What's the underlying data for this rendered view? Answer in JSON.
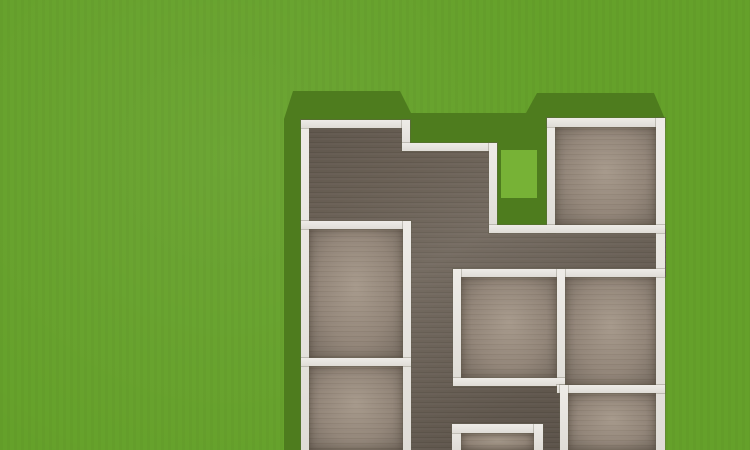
{
  "scene": {
    "width": 750,
    "height": 450,
    "view": "top-down floor plan of a house on a grass lot"
  },
  "colors": {
    "grass": "#65a12a",
    "shadow": "#4e7c1e",
    "courtyard_sunlit": "#77b236",
    "wall": "#e8e5df",
    "dark_floor": "#675d52",
    "light_floor": "#93867a"
  },
  "geometry": {
    "shadow_polygon": [
      [
        284,
        450
      ],
      [
        284,
        119
      ],
      [
        293,
        91
      ],
      [
        400,
        91
      ],
      [
        411,
        113
      ],
      [
        526,
        113
      ],
      [
        537,
        93
      ],
      [
        654,
        93
      ],
      [
        665,
        119
      ],
      [
        665,
        150
      ],
      [
        310,
        150
      ],
      [
        310,
        450
      ]
    ],
    "courtyard": {
      "shadow": {
        "x": 493,
        "y": 135,
        "w": 62,
        "h": 98
      },
      "sunlit": {
        "x": 501,
        "y": 150,
        "w": 36,
        "h": 48
      }
    },
    "hallway_polygon": [
      [
        305,
        124
      ],
      [
        407,
        124
      ],
      [
        407,
        147
      ],
      [
        497,
        147
      ],
      [
        497,
        229
      ],
      [
        666,
        229
      ],
      [
        666,
        277
      ],
      [
        457,
        277
      ],
      [
        457,
        382
      ],
      [
        564,
        382
      ],
      [
        564,
        450
      ],
      [
        407,
        450
      ],
      [
        407,
        229
      ],
      [
        305,
        229
      ]
    ],
    "rooms": [
      {
        "id": "room-top-right",
        "x": 555,
        "y": 127,
        "w": 101,
        "h": 98
      },
      {
        "id": "room-left-middle",
        "x": 309,
        "y": 229,
        "w": 94,
        "h": 129
      },
      {
        "id": "room-left-bottom",
        "x": 309,
        "y": 366,
        "w": 94,
        "h": 84
      },
      {
        "id": "room-center",
        "x": 461,
        "y": 277,
        "w": 96,
        "h": 101
      },
      {
        "id": "room-right-middle",
        "x": 565,
        "y": 277,
        "w": 91,
        "h": 108
      },
      {
        "id": "room-bottom-center",
        "x": 461,
        "y": 433,
        "w": 73,
        "h": 17
      },
      {
        "id": "room-bottom-right",
        "x": 568,
        "y": 393,
        "w": 88,
        "h": 57
      }
    ],
    "walls": [
      {
        "id": "wall-exterior-west",
        "x": 301,
        "y": 120,
        "w": 8,
        "h": 330
      },
      {
        "id": "wall-top-left",
        "x": 301,
        "y": 120,
        "w": 109,
        "h": 8
      },
      {
        "id": "wall-step",
        "x": 402,
        "y": 120,
        "w": 8,
        "h": 31
      },
      {
        "id": "wall-top-recess",
        "x": 402,
        "y": 143,
        "w": 95,
        "h": 8
      },
      {
        "id": "wall-courtyard-west",
        "x": 489,
        "y": 143,
        "w": 8,
        "h": 90
      },
      {
        "id": "wall-courtyard-east",
        "x": 547,
        "y": 118,
        "w": 8,
        "h": 115
      },
      {
        "id": "wall-top-right",
        "x": 547,
        "y": 118,
        "w": 118,
        "h": 9
      },
      {
        "id": "wall-exterior-east",
        "x": 656,
        "y": 118,
        "w": 9,
        "h": 332
      },
      {
        "id": "wall-left-mid",
        "x": 301,
        "y": 221,
        "w": 110,
        "h": 8
      },
      {
        "id": "wall-hall-west",
        "x": 403,
        "y": 221,
        "w": 8,
        "h": 229
      },
      {
        "id": "wall-left-lower",
        "x": 301,
        "y": 358,
        "w": 110,
        "h": 8
      },
      {
        "id": "wall-mid-right",
        "x": 489,
        "y": 225,
        "w": 176,
        "h": 8
      },
      {
        "id": "wall-center-top",
        "x": 453,
        "y": 269,
        "w": 212,
        "h": 8
      },
      {
        "id": "wall-center-west",
        "x": 453,
        "y": 269,
        "w": 8,
        "h": 117
      },
      {
        "id": "wall-center-divider",
        "x": 557,
        "y": 269,
        "w": 8,
        "h": 124
      },
      {
        "id": "wall-center-bottom",
        "x": 453,
        "y": 378,
        "w": 112,
        "h": 8
      },
      {
        "id": "wall-right-bottom",
        "x": 557,
        "y": 385,
        "w": 108,
        "h": 8
      },
      {
        "id": "wall-bottom-right-west",
        "x": 560,
        "y": 385,
        "w": 8,
        "h": 65
      },
      {
        "id": "wall-bc-west",
        "x": 452,
        "y": 424,
        "w": 9,
        "h": 26
      },
      {
        "id": "wall-bc-top",
        "x": 452,
        "y": 424,
        "w": 91,
        "h": 9
      },
      {
        "id": "wall-bc-east",
        "x": 534,
        "y": 424,
        "w": 9,
        "h": 26
      }
    ]
  }
}
